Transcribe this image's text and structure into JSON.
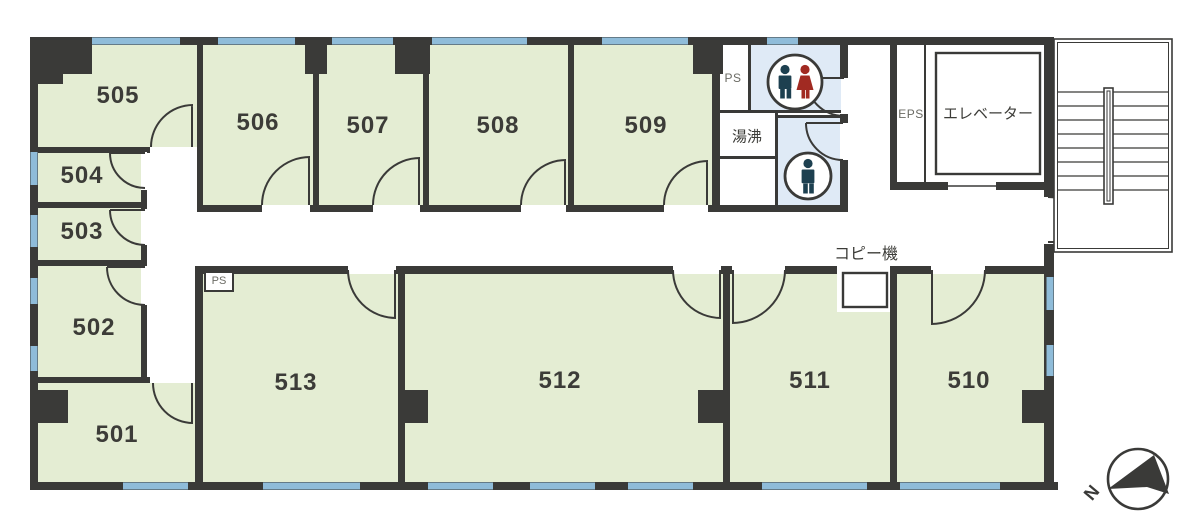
{
  "rooms": {
    "r501": "501",
    "r502": "502",
    "r503": "503",
    "r504": "504",
    "r505": "505",
    "r506": "506",
    "r507": "507",
    "r508": "508",
    "r509": "509",
    "r510": "510",
    "r511": "511",
    "r512": "512",
    "r513": "513"
  },
  "labels": {
    "ps_top": "PS",
    "ps_bottom": "PS",
    "kitchenette": "湯沸",
    "eps": "EPS",
    "elevator": "エレベーター",
    "copier": "コピー機",
    "north": "N"
  },
  "icons": {
    "wc_shared": "male-female-restroom-icon",
    "wc_male": "male-restroom-icon",
    "compass": "north-arrow-icon"
  },
  "colors": {
    "wall": "#3a3a38",
    "room_fill": "#e4edd3",
    "window_blue": "#8fbcd9",
    "wc_fill": "#dfeaf6",
    "male_icon": "#1d4050",
    "female_icon": "#a12a22",
    "label_gray": "#6b6b64",
    "background": "#ffffff"
  }
}
